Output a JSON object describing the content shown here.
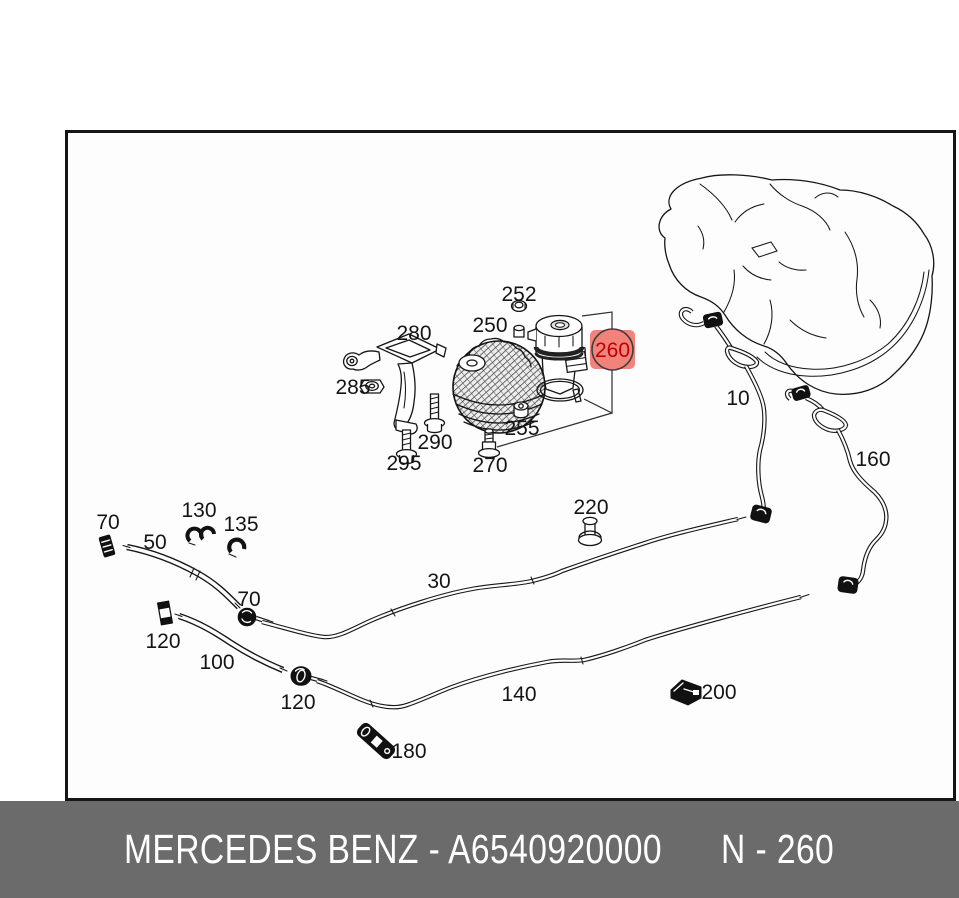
{
  "caption": {
    "brand_part": "MERCEDES BENZ - A6540920000",
    "ref": "N - 260",
    "bg": "#6B6B6B",
    "fg": "#FFFFFF"
  },
  "highlight": {
    "label": "260",
    "bg": "#F2837B",
    "ring": "#3D3D3D",
    "fg": "#C00000"
  },
  "callouts": {
    "c70a": "70",
    "c50": "50",
    "c130": "130",
    "c135": "135",
    "c70b": "70",
    "c120a": "120",
    "c100": "100",
    "c120b": "120",
    "c30": "30",
    "c140": "140",
    "c220": "220",
    "c180": "180",
    "c200": "200",
    "c10": "10",
    "c160": "160",
    "c280": "280",
    "c285": "285",
    "c290": "290",
    "c295": "295",
    "c250": "250",
    "c252": "252",
    "c255": "255",
    "c270": "270"
  },
  "line_color": "#161616"
}
